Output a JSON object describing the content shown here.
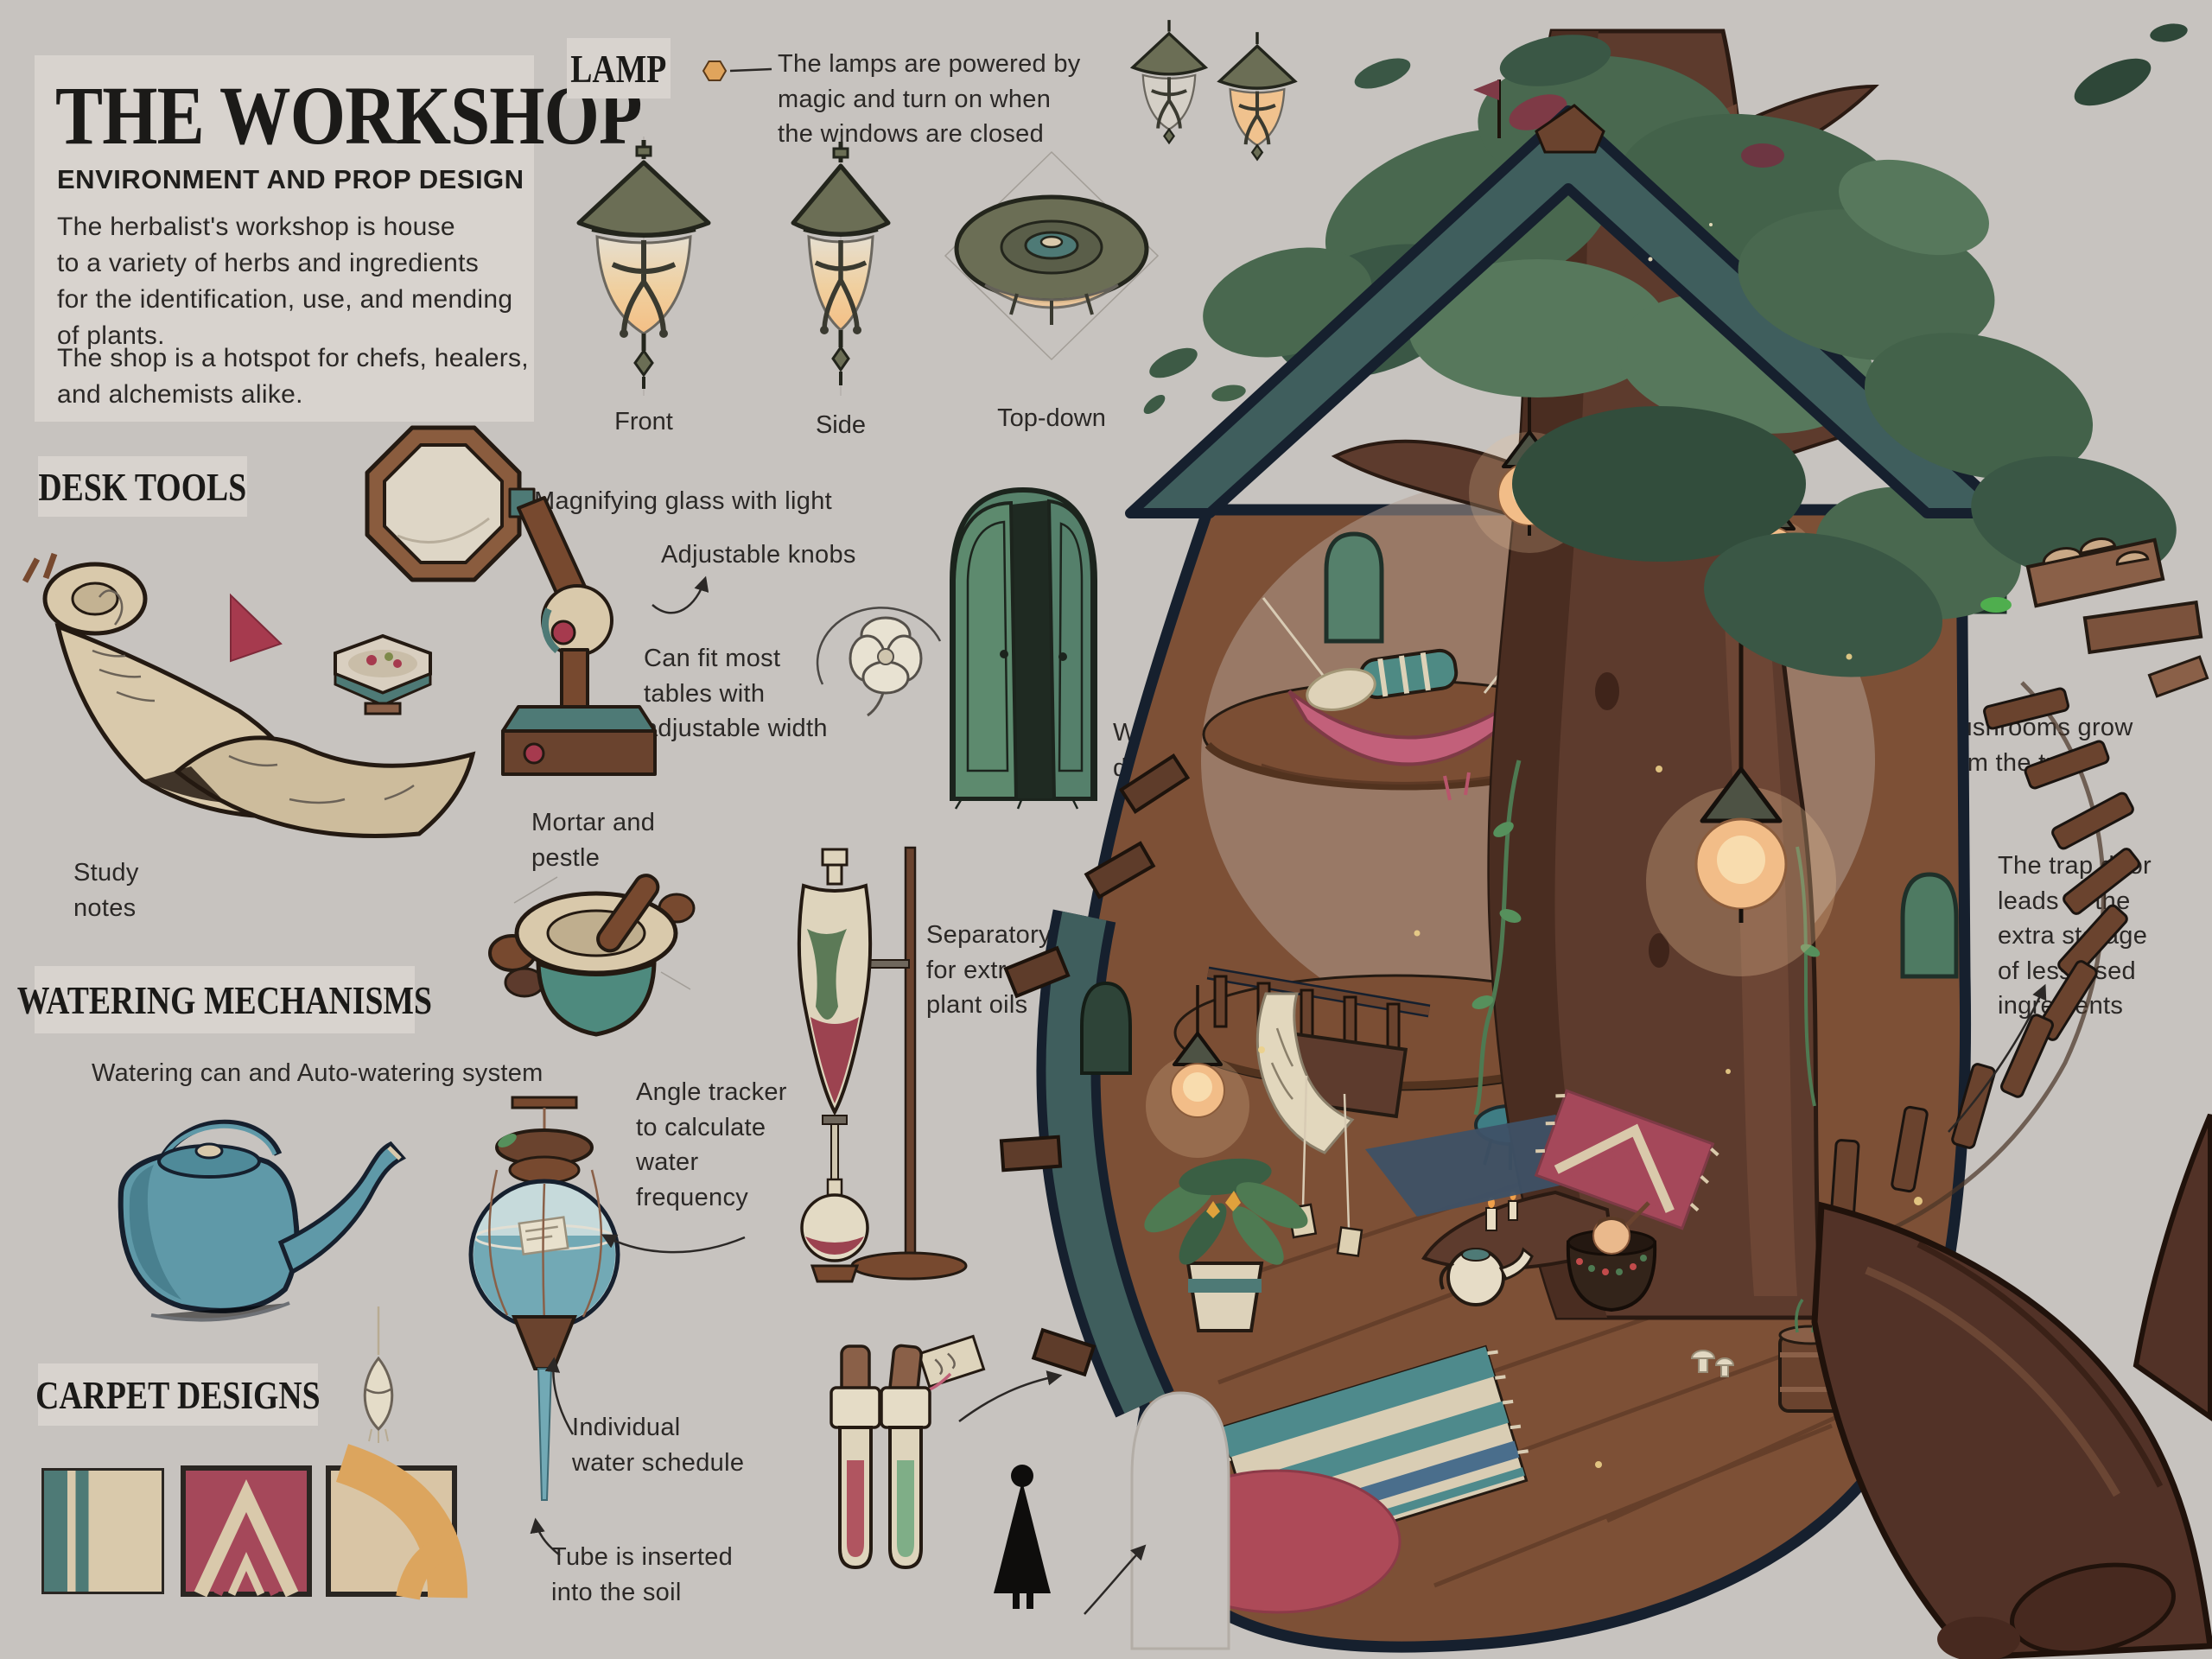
{
  "palette": {
    "background": "#c7c3bf",
    "panel": "#d8d3ce",
    "ink": "#2b2826",
    "heading": "#1b1a18",
    "roof_slate": "#3f5e5d",
    "outline_navy": "#16202e",
    "wood_floor": "#7d5036",
    "trunk_brown": "#5d3b2d",
    "canopy_green": "#49684f",
    "lamp_glow": "#f2c48f",
    "watering_teal": "#5f99a8",
    "door_green": "#5d8a6e",
    "rug_red": "#a5485a",
    "cream": "#d9c9ab",
    "carpet_orange": "#dca55e"
  },
  "title_panel": {
    "title": "THE WORKSHOP",
    "subtitle": "ENVIRONMENT AND PROP DESIGN",
    "body_1": "The herbalist's workshop is house\nto a variety of herbs and ingredients\nfor the identification, use, and mending\nof plants.",
    "body_2": "The shop is a hotspot for chefs, healers,\nand alchemists alike."
  },
  "lamp": {
    "heading": "LAMP",
    "note": "The lamps are powered by\nmagic and turn on when\nthe windows are closed",
    "views": [
      "Front",
      "Side",
      "Top-down"
    ]
  },
  "desk_tools": {
    "heading": "DESK TOOLS",
    "magnifier_label": "Magnifying glass with light",
    "knobs_label": "Adjustable knobs",
    "fit_label": "Can fit most\ntables with\nadjustable width",
    "mortar_label": "Mortar and\npestle",
    "study_label": "Study\nnotes"
  },
  "props": {
    "window_label": "Window\ndesign",
    "funnel_label": "Separatory funnel\nfor extracting\nplant oils"
  },
  "watering": {
    "heading": "WATERING MECHANISMS",
    "subtitle": "Watering can and Auto-watering system",
    "angle_label": "Angle tracker\nto calculate\nwater\nfrequency",
    "schedule_label": "Individual\nwater schedule",
    "tube_label": "Tube is inserted\ninto the soil"
  },
  "carpets": {
    "heading": "CARPET DESIGNS",
    "designs": [
      {
        "name": "stripe",
        "colors": [
          "#4e7a76",
          "#d9c9ab"
        ]
      },
      {
        "name": "chevron",
        "colors": [
          "#a5485a",
          "#d9c9ab"
        ]
      },
      {
        "name": "arches",
        "colors": [
          "#d9c5a5",
          "#dca55e"
        ]
      }
    ]
  },
  "treehouse": {
    "mushrooms_label": "Mushrooms grow\nfrom the tree",
    "trapdoor_label": "The trap door\nleads to the\nextra storage\nof less-used\ningredients"
  }
}
